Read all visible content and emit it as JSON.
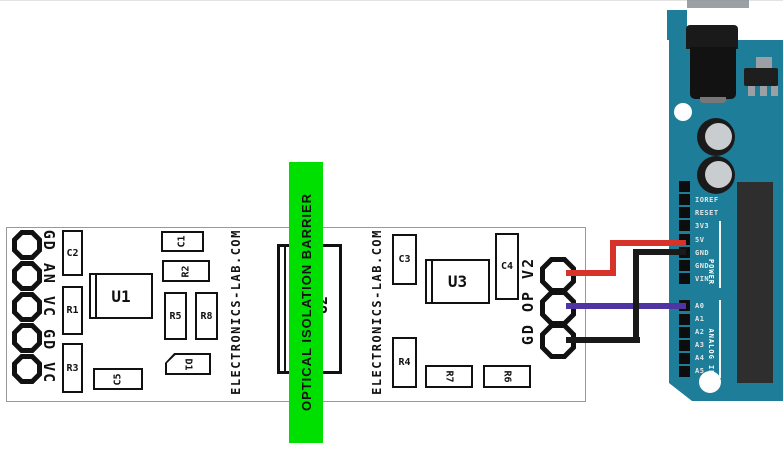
{
  "pcb": {
    "outline_color": "#999999",
    "silkscreen_color": "#111111",
    "brand": "ELECTRONICS-LAB.COM",
    "left_module": {
      "pad_labels": "GD AN VC GD VC",
      "pad_count": 5,
      "components": {
        "c2": "C2",
        "r1": "R1",
        "r3": "R3",
        "u1": "U1",
        "c5": "C5",
        "c1": "C1",
        "r2": "R2",
        "r5": "R5",
        "r8": "R8",
        "d1": "D1"
      }
    },
    "right_module": {
      "pad_labels": "GD OP V2",
      "pad_count": 3,
      "components": {
        "c3": "C3",
        "u3": "U3",
        "c4": "C4",
        "r4": "R4",
        "r7": "R7",
        "r6": "R6"
      }
    },
    "isolator_label": "U2",
    "barrier": {
      "text": "OPTICAL ISOLATION BARRIER",
      "color": "#00e000"
    }
  },
  "wires": {
    "power": {
      "color": "#d8332b",
      "from_pad": "V2",
      "to_pin": "5V"
    },
    "signal": {
      "color": "#4e35a3",
      "from_pad": "OP",
      "to_pin": "A0"
    },
    "ground": {
      "color": "#1a1a1a",
      "from_pad": "GD",
      "to_pin": "GND"
    }
  },
  "arduino": {
    "board_color": "#1e7d98",
    "power_header": {
      "group_label": "POWER",
      "pins": [
        "",
        "IOREF",
        "RESET",
        "3V3",
        "5V",
        "GND",
        "GND",
        "VIN"
      ]
    },
    "analog_header": {
      "group_label": "ANALOG IN",
      "pins": [
        "A0",
        "A1",
        "A2",
        "A3",
        "A4",
        "A5"
      ]
    }
  }
}
